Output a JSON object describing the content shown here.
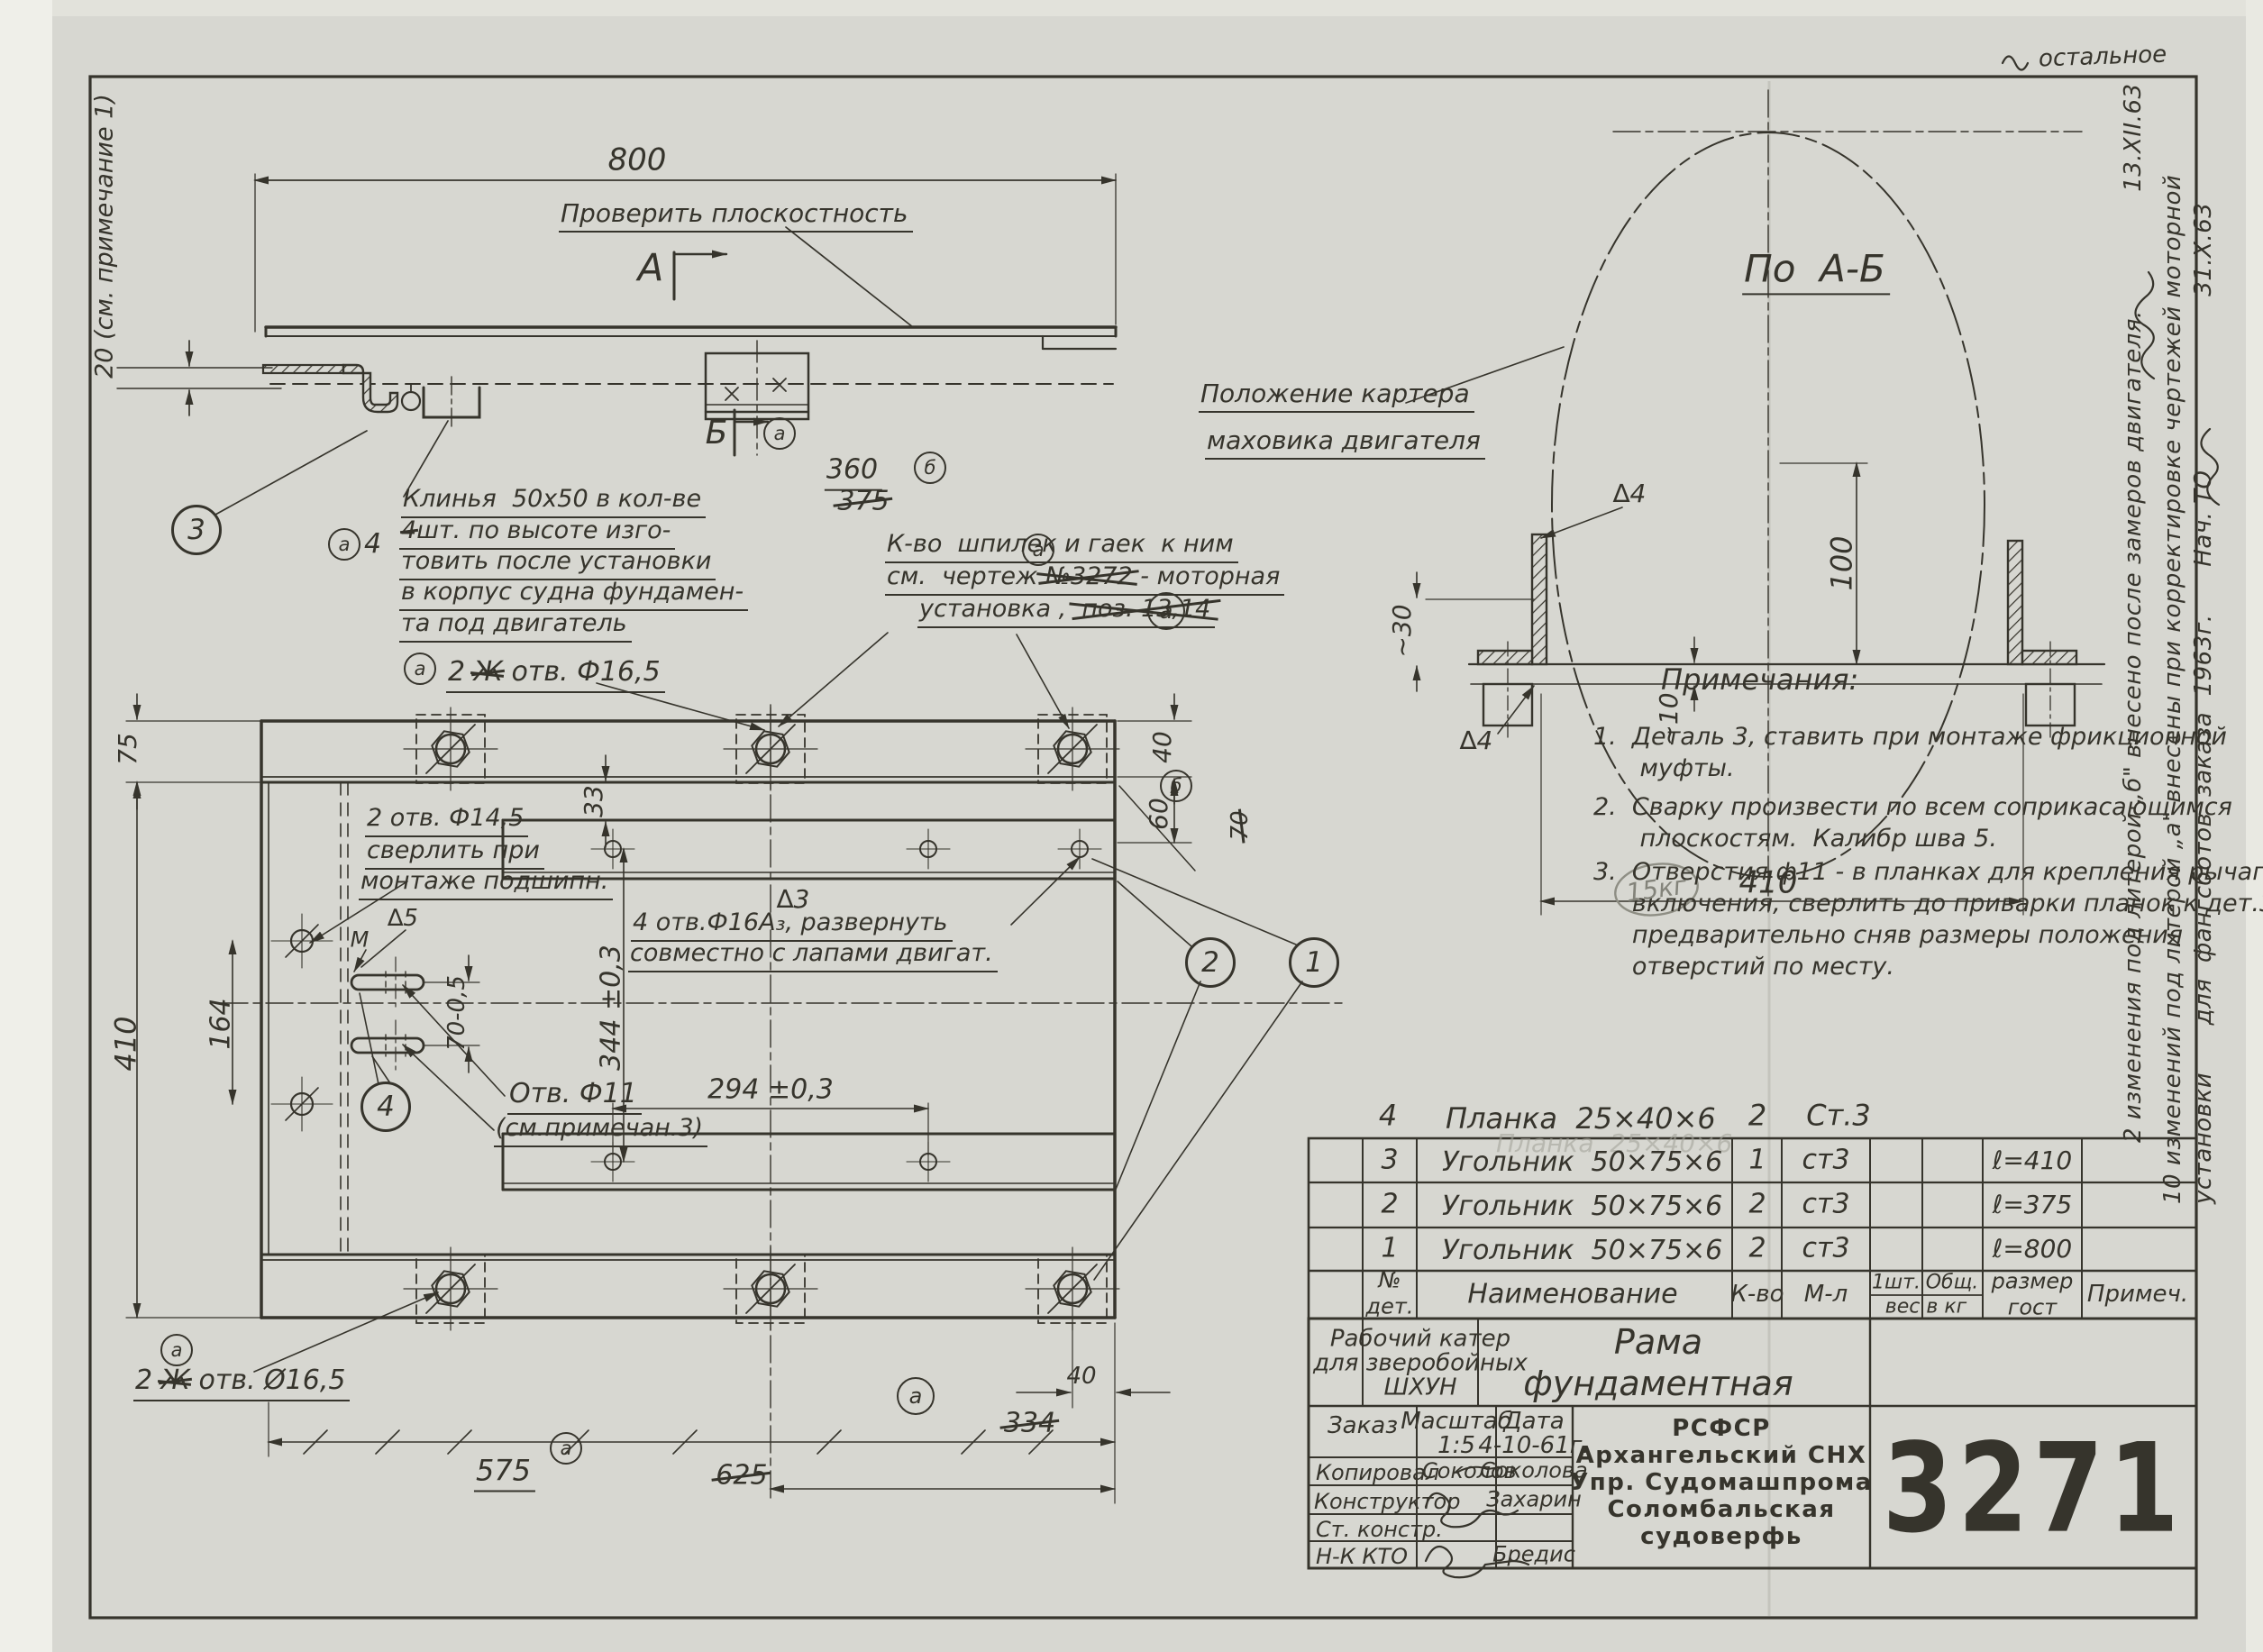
{
  "sheet": {
    "surface_mark": "остальное",
    "weight_note": "15кг"
  },
  "side_view": {
    "dim_800": "800",
    "gap_note": "20 (см. примечание 1)",
    "check_flatness": "Проверить плоскостность",
    "section_a": "А",
    "section_b": "Б",
    "dim_360": "360",
    "dim_375_old": "375",
    "mark_b": "б",
    "mark_a": "а",
    "balloon_3": "3",
    "wedge_mark": "а",
    "wedge_qty": "4",
    "wedge_note": {
      "l1": "Клинья  50х50 в кол-ве",
      "l2_old": "4",
      "l2": "шт. по высоте изго-",
      "l3": "товить после установки",
      "l4": "в корпус судна фундамен-",
      "l5": "та под двигатель"
    },
    "stud_note": {
      "l1": "К-во  шпилек и гаек  к ним",
      "l2a": "см.  чертеж ",
      "l2_old": "№3272",
      "l2_mark": "а",
      "l2b": " - моторная",
      "l3a": "установка ,  ",
      "l3_old": "поз. 13,14",
      "l3_mark": "а"
    }
  },
  "section_view": {
    "title": "По  А-Б",
    "crankcase_l1": "Положение картера",
    "crankcase_l2": "маховика двигателя",
    "weld_top": "∆4",
    "weld_bottom": "∆4",
    "dim_30": "~30",
    "dim_10": "~10",
    "dim_100": "100",
    "dim_410": "410"
  },
  "plan_view": {
    "holes_165_top": {
      "mark": "а",
      "qty": "2 ",
      "old": "Ж",
      "label": " отв. Ф16,5"
    },
    "holes_165_bottom": {
      "mark": "а",
      "qty": "2 ",
      "old": "Ж",
      "label": " отв. Ø16,5"
    },
    "dim_75": "75",
    "dim_410": "410",
    "dim_164": "164",
    "dim_33": "33",
    "holes_145": {
      "l1": "2 отв. Ф14,5",
      "l2": "сверлить при",
      "l3": "монтаже подшипн."
    },
    "dim_344": "344 ±0,3",
    "dim_70": "70-0,5",
    "weld_5": "∆5",
    "datum_m": "М",
    "weld_3": "∆3",
    "holes_16": {
      "l1": "4 отв.Ф16А₃, развернуть",
      "l2": "совместно с лапами двигат."
    },
    "dim_294": "294 ±0,3",
    "hole_11": {
      "l1": "Отв. Ф11",
      "l2": "(см.примечан.3)"
    },
    "balloon_4": "4",
    "balloon_2": "2",
    "balloon_1": "1",
    "dim_40_right": "40",
    "mark_b": "б",
    "dim_60": "60",
    "dim_70_old": "70",
    "mark_334": "а",
    "dim_334_old": "334",
    "dim_40_bottom": "40",
    "dim_575": "575",
    "dim_625_old": "625",
    "mark_575": "а"
  },
  "notes": {
    "heading": "Примечания:",
    "n1": "1.  Деталь 3, ставить при монтаже фрикционной\n      муфты.",
    "n2": "2.  Сварку произвести по всем соприкасающимся\n      плоскостям.  Калибр шва 5.",
    "n3": "3.  Отверстия ф11 - в планках для крепления рычага\n     включения, сверлить до приварки планок к дет.3,\n     предварительно сняв размеры положения\n     отверстий по месту."
  },
  "revisions": {
    "r1": "2 изменения под литерой „б\" внесено после замеров двигателя.               13.XII.63",
    "r2": "10 изменений под литерой „а\" внесены при корректировке чертежей моторной",
    "r3": "установки      для  фангсботов  заказа  1963г.      Нач. ТО                      31.X.63"
  },
  "parts_table": {
    "extra_row": {
      "num": "4",
      "name": "Планка  25×40×6",
      "qty": "2",
      "mat": "Ст.3"
    },
    "ghost": "Планка  25×40×6",
    "rows": [
      {
        "num": "3",
        "name": "Угольник  50×75×6",
        "qty": "1",
        "mat": "ст3",
        "size": "ℓ=410"
      },
      {
        "num": "2",
        "name": "Угольник  50×75×6",
        "qty": "2",
        "mat": "ст3",
        "size": "ℓ=375"
      },
      {
        "num": "1",
        "name": "Угольник  50×75×6",
        "qty": "2",
        "mat": "ст3",
        "size": "ℓ=800"
      }
    ],
    "header": {
      "num": "№\nдет.",
      "name": "Наименование",
      "qty": "К-во",
      "mat": "М-л",
      "w1": "1шт.",
      "w2": "Общ.",
      "w3": "вес в кг",
      "size": "размер\nгост",
      "note": "Примеч."
    }
  },
  "title_block": {
    "object": "Рабочий катер\nдля зверобойных\nШХУН",
    "title": "Рама\nфундаментная",
    "order_label": "Заказ",
    "scale_label": "Масштаб",
    "scale": "1:5",
    "date_label": "Дата",
    "date": "4-10-61г.",
    "row_copied": "Копировал",
    "sig_copied": "Соколов",
    "name_copied": "Соколова",
    "row_designer": "Конструктор",
    "name_designer": "Захарин",
    "row_senior": "Ст. констр.",
    "row_nk": "Н-К КТО",
    "name_nk": "Бредис",
    "org": "РСФСР\nАрхангельский СНХ\nУпр. Судомашпрома\nСоломбальская\nсудоверфь",
    "number": "3271"
  }
}
